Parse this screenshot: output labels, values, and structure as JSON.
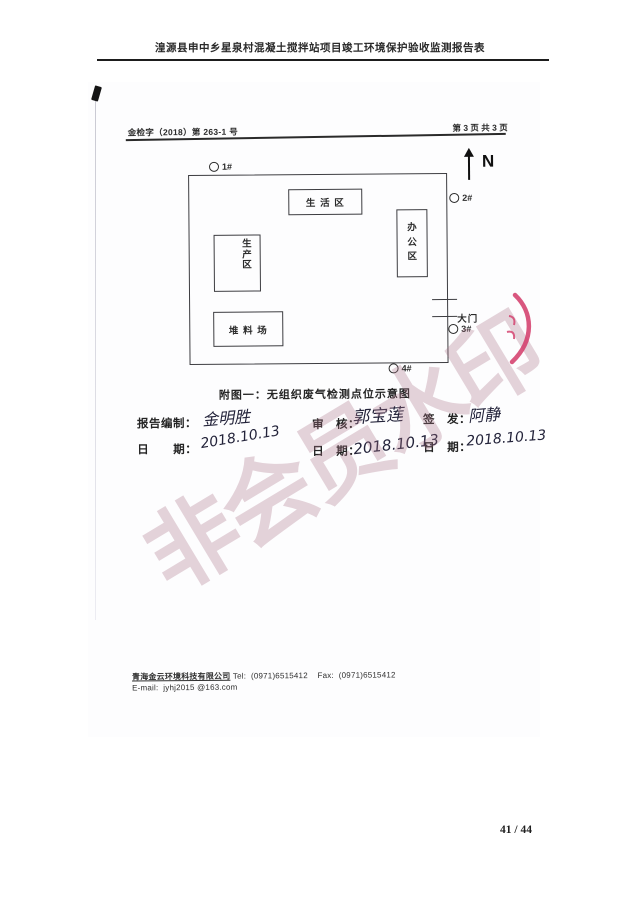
{
  "page": {
    "title": "湟源县申中乡星泉村混凝土搅拌站项目竣工环境保护验收监测报告表",
    "page_number": "41 / 44"
  },
  "scan": {
    "doc_number": "金检字（2018）第 263-1 号",
    "page_indicator": "第 3 页 共 3 页",
    "watermark": "非会员水印",
    "diagram": {
      "north": "N",
      "points": [
        {
          "label": "1#"
        },
        {
          "label": "2#"
        },
        {
          "label": "3#"
        },
        {
          "label": "4#"
        }
      ],
      "areas": {
        "living": "生 活 区",
        "office": "办\n公\n区",
        "production": "生\n产\n区",
        "stockyard": "堆 料 场",
        "gate": "大门"
      },
      "caption": "附图一：无组织废气检测点位示意图"
    },
    "signatures": {
      "prepared_label": "报告编制：",
      "prepared_name": "金明胜",
      "prepared_date_label": "日　　期：",
      "prepared_date": "2018.10.13",
      "reviewed_label": "审　核：",
      "reviewed_name": "郭宝莲",
      "reviewed_date_label": "日　期：",
      "reviewed_date": "2018.10.13",
      "issued_label": "签　发：",
      "issued_name": "阿静",
      "issued_date_label": "日　期：",
      "issued_date": "2018.10.13"
    },
    "footer": {
      "company": "青海金云环境科技有限公司",
      "tel_label": "Tel:",
      "tel": "(0971)6515412",
      "fax_label": "Fax:",
      "fax": "(0971)6515412",
      "email_label": "E-mail:",
      "email": "jyhj2015 @163.com"
    },
    "colors": {
      "watermark_pink": "#c9a0ac",
      "seal_red": "#d23a68",
      "ink": "#2b2b2b"
    }
  }
}
